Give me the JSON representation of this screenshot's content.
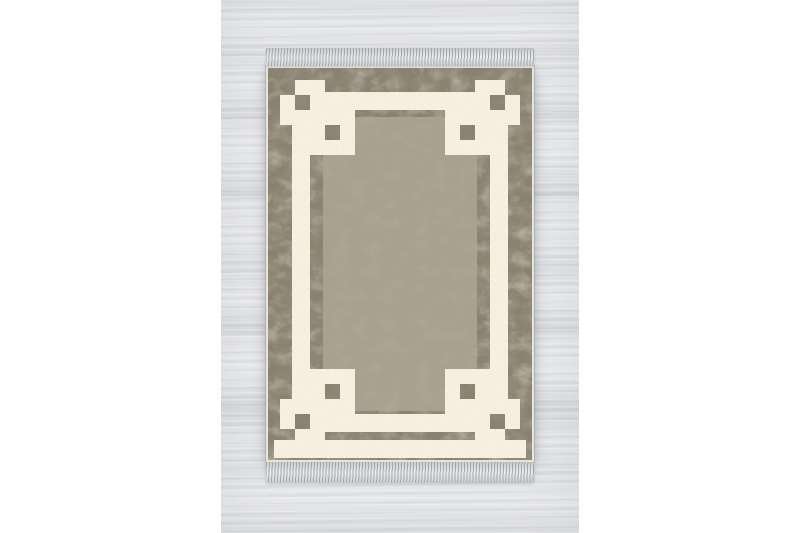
{
  "scene": {
    "canvas_background": "#ffffff",
    "subject": "taupe vintage rug with cream greek-key corner border on whitewashed wood floor"
  },
  "photo": {
    "floor": {
      "base": "#e0e1e3",
      "plank_light": "#eaebec",
      "plank_dark": "#d2d4d6",
      "seam": "#c7cacd"
    }
  },
  "rug": {
    "colors": {
      "selvage": "#e9e5d8",
      "border_base": "#8a8170",
      "border_dark_mottle": "#5c5440",
      "border_light_mottle": "#b8af99",
      "field": "#a9a190",
      "motif_cream": "#f7efe0",
      "fringe_light": "#eceeef",
      "fringe_dark": "#9a9ea2"
    },
    "geometry": {
      "width": 268,
      "height": 396,
      "bottom_mirror": 392,
      "inner_margin": 2,
      "field_rect": [
        57,
        51,
        154,
        294
      ],
      "long_bands": [
        [
          59,
          26,
          150,
          18
        ],
        [
          59,
          348,
          150,
          18
        ],
        [
          26,
          59,
          18,
          274
        ],
        [
          224,
          59,
          18,
          274
        ]
      ],
      "edge_strip": [
        8,
        374,
        252,
        18
      ],
      "corner_rects": [
        [
          29,
          14,
          30,
          15
        ],
        [
          14,
          29,
          15,
          30
        ],
        [
          44,
          14,
          15,
          45
        ],
        [
          14,
          44,
          45,
          15
        ],
        [
          59,
          44,
          30,
          15
        ],
        [
          74,
          44,
          15,
          45
        ],
        [
          44,
          59,
          15,
          30
        ],
        [
          44,
          74,
          30,
          15
        ]
      ],
      "hole_rects": [
        [
          29,
          29,
          15,
          15
        ],
        [
          59,
          59,
          15,
          15
        ]
      ]
    }
  }
}
